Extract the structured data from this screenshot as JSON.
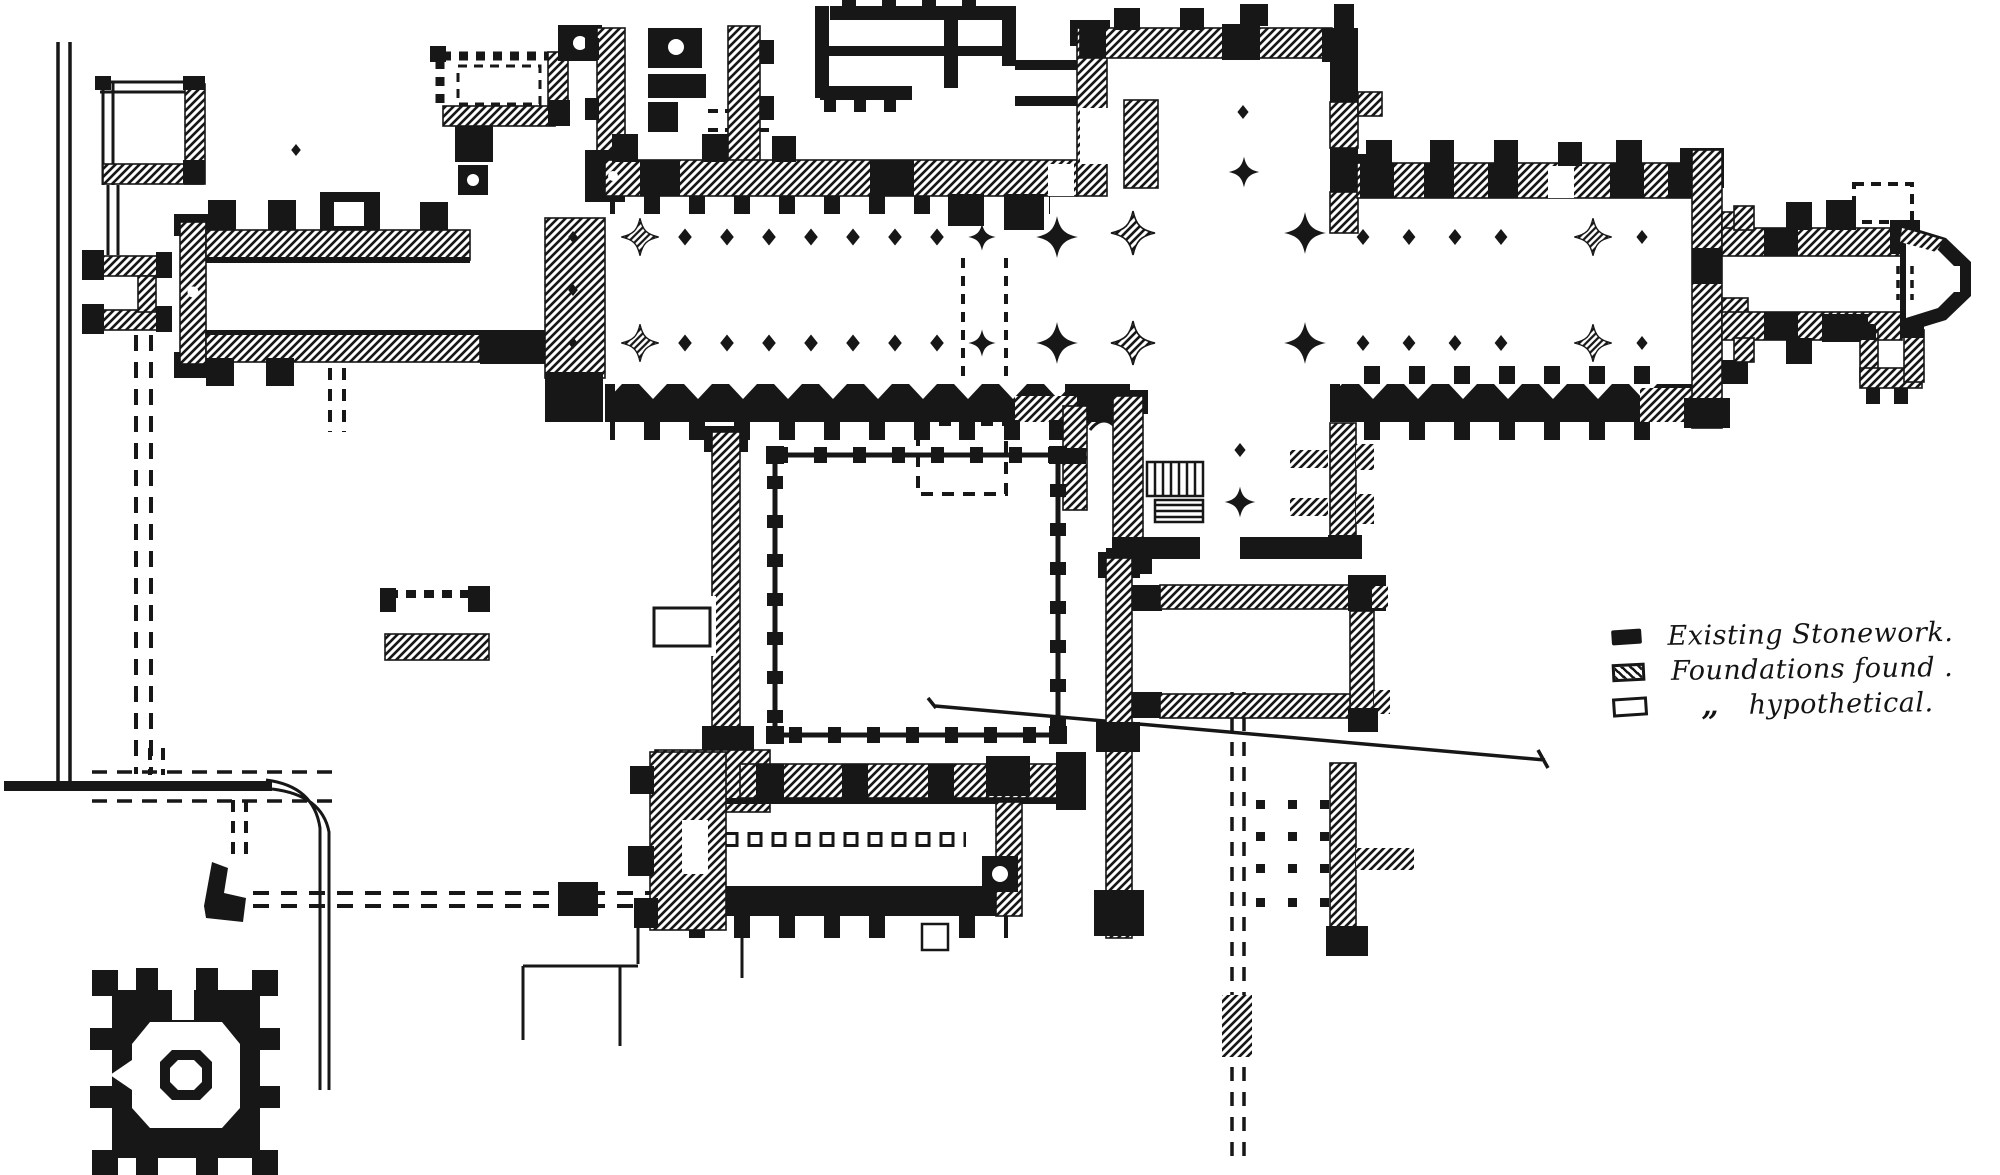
{
  "figure": {
    "kind": "engraved architectural floor plan of an abbey church and monastic buildings",
    "background_color": "#ffffff",
    "ink_color": "#171717"
  },
  "legend": {
    "items": [
      {
        "id": "existing-stonework",
        "swatch": "solid",
        "label": "Existing Stonework."
      },
      {
        "id": "foundations-found",
        "swatch": "hatched",
        "label": "Foundations found ."
      },
      {
        "id": "hypothetical",
        "swatch": "outline",
        "ditto": "„",
        "label": "hypothetical."
      }
    ]
  }
}
